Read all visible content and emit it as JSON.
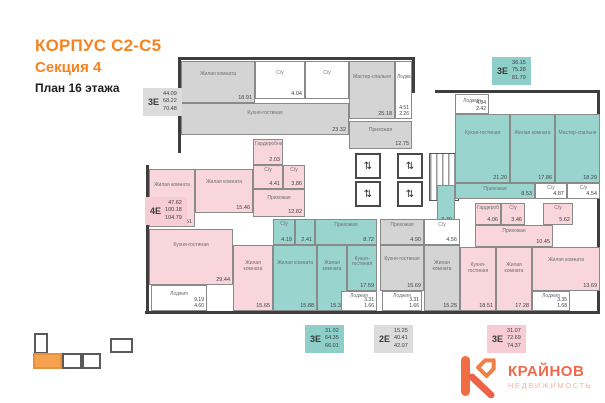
{
  "header": {
    "building": "КОРПУС С2-С5",
    "section": "Секция 4",
    "floor": "План 16 этажа"
  },
  "colors": {
    "accent_orange": "#F5831F",
    "apartment_pink": "#F9D6DC",
    "apartment_teal": "#9AD4CF",
    "apartment_gray": "#D4D4D5",
    "minimap_active": "#F5A14E",
    "logo_coral": "#EE6A4A"
  },
  "core": {
    "lift_glyph": "⇅"
  },
  "apartments": [
    {
      "type": "3Е",
      "areas": {
        "living": "44.09",
        "base": "68.22",
        "total": "70.48"
      },
      "rooms": [
        {
          "name": "Жилая комната",
          "area": "18.91"
        },
        {
          "name": "С/у",
          "area": "4.04"
        },
        {
          "name": "С/у",
          "area": ""
        },
        {
          "name": "Кухня-гостиная",
          "area": "23.32"
        },
        {
          "name": "Мастер-спальня",
          "area": "25.18"
        },
        {
          "name": "Лоджия",
          "area": "4.51",
          "area2": "2.26"
        },
        {
          "name": "Прихожая",
          "area": "12.75"
        }
      ]
    },
    {
      "type": "3Е",
      "areas": {
        "living": "36.15",
        "base": "75.28",
        "total": "81.70"
      },
      "rooms": [
        {
          "name": "Лоджия",
          "area": "4.84",
          "area2": "2.42"
        },
        {
          "name": "Кухня-гостиная",
          "area": "21.20"
        },
        {
          "name": "Жилая комната",
          "area": "17.86"
        },
        {
          "name": "Мастер-спальня",
          "area": "18.29"
        },
        {
          "name": "Гардероб",
          "area": "3.39"
        },
        {
          "name": "Прихожая",
          "area": "8.53"
        },
        {
          "name": "С/у",
          "area": "4.87"
        },
        {
          "name": "С/у",
          "area": "4.54"
        }
      ]
    },
    {
      "type": "4Е",
      "areas": {
        "living": "47.62",
        "base": "100.18",
        "total": "104.79"
      },
      "rooms": [
        {
          "name": "Жилая комната",
          "area": "16.51"
        },
        {
          "name": "Жилая комната",
          "area": "15.46"
        },
        {
          "name": "Гардеробная",
          "area": "2.03"
        },
        {
          "name": "С/у",
          "area": "4.41"
        },
        {
          "name": "С/у",
          "area": "3.86"
        },
        {
          "name": "Прихожая",
          "area": "12.82"
        },
        {
          "name": "Кухня-гостиная",
          "area": "29.44"
        },
        {
          "name": "Жилая комната",
          "area": "15.65"
        },
        {
          "name": "Лоджия",
          "area": "9.19",
          "area2": "4.60"
        }
      ]
    },
    {
      "type": "3Е",
      "areas": {
        "living": "31.02",
        "base": "64.35",
        "total": "66.01"
      },
      "rooms": [
        {
          "name": "С/у",
          "area": "4.19"
        },
        {
          "name": "Гардероб",
          "area": "2.41"
        },
        {
          "name": "Прихожая",
          "area": "8.72"
        },
        {
          "name": "Жилая комната",
          "area": "15.88"
        },
        {
          "name": "Жилая комната",
          "area": "15.34"
        },
        {
          "name": "Кухня-гостиная",
          "area": "17.59"
        },
        {
          "name": "Лоджия",
          "area": "3.31",
          "area2": "1.66"
        }
      ]
    },
    {
      "type": "2Е",
      "areas": {
        "living": "15.25",
        "base": "40.41",
        "total": "42.07"
      },
      "rooms": [
        {
          "name": "Прихожая",
          "area": "4.90"
        },
        {
          "name": "С/у",
          "area": "4.56"
        },
        {
          "name": "Кухня-гостиная",
          "area": "15.69"
        },
        {
          "name": "Жилая комната",
          "area": "15.25"
        },
        {
          "name": "Лоджия",
          "area": "3.31",
          "area2": "1.66"
        }
      ]
    },
    {
      "type": "3Е",
      "areas": {
        "living": "31.07",
        "base": "72.69",
        "total": "74.37"
      },
      "rooms": [
        {
          "name": "Гардероб",
          "area": "4.06"
        },
        {
          "name": "С/у",
          "area": "3.46"
        },
        {
          "name": "С/у",
          "area": "5.62"
        },
        {
          "name": "Прихожая",
          "area": "10.45"
        },
        {
          "name": "Кухня-гостиная",
          "area": "18.51"
        },
        {
          "name": "Жилая комната",
          "area": "17.28"
        },
        {
          "name": "Жилая комната",
          "area": "13.69"
        },
        {
          "name": "Лоджия",
          "area": "3.35",
          "area2": "1.68"
        }
      ]
    }
  ],
  "logo": {
    "name": "КРАЙНОВ",
    "subtitle": "НЕДВИЖИМОСТЬ"
  }
}
